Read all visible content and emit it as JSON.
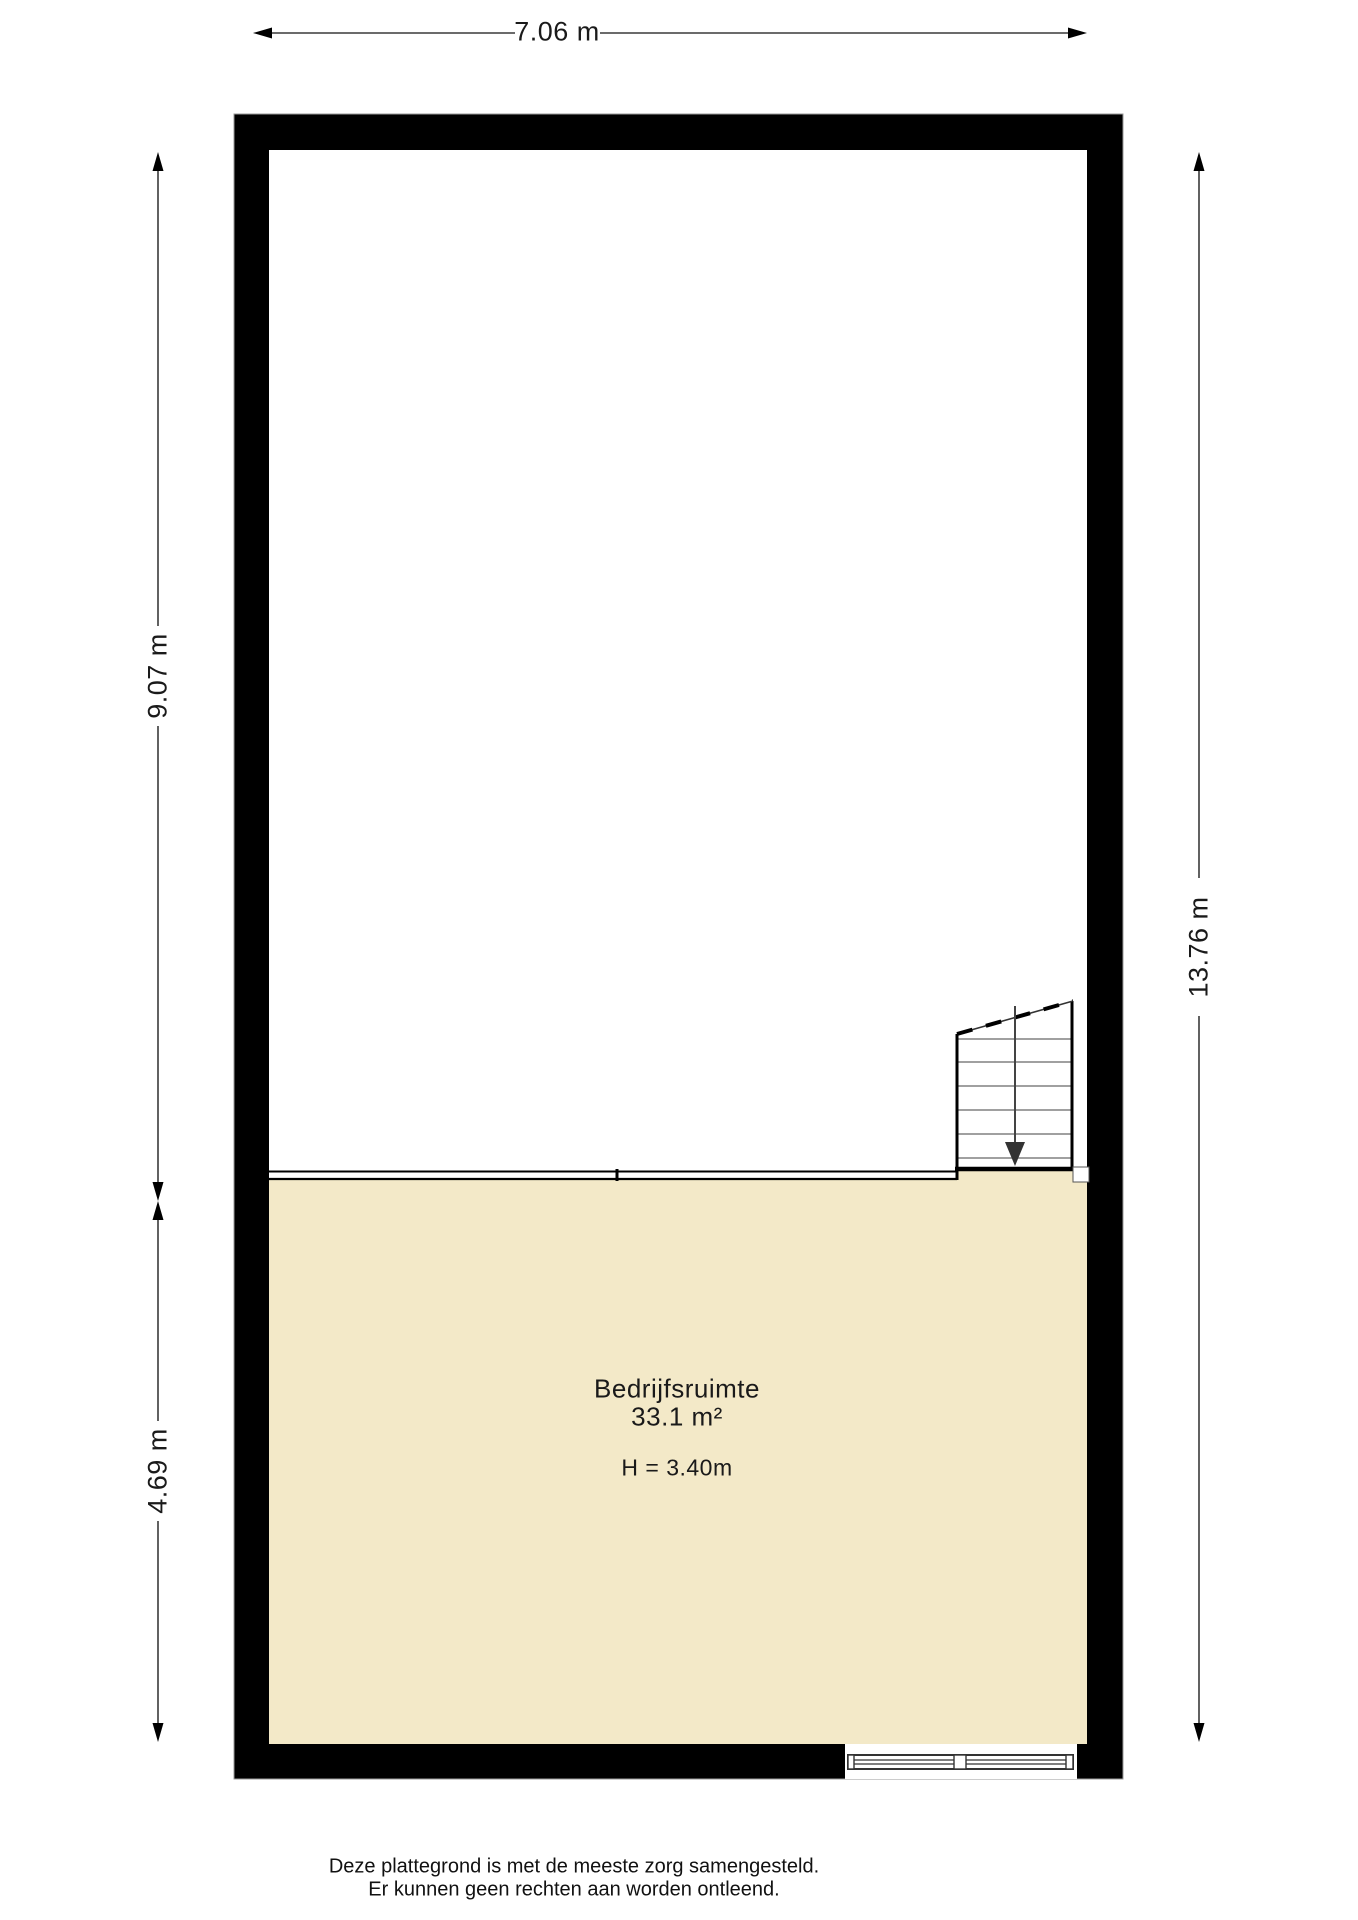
{
  "dimensions": {
    "top": "7.06 m",
    "left_upper": "9.07 m",
    "left_lower": "4.69 m",
    "right": "13.76 m"
  },
  "room": {
    "name": "Bedrijfsruimte",
    "area": "33.1 m²",
    "height": "H = 3.40m"
  },
  "footer": {
    "line1": "Deze plattegrond is met de meeste zorg samengesteld.",
    "line2": "Er kunnen geen rechten aan worden ontleend."
  },
  "colors": {
    "wall": "#000000",
    "floor": "#f3e9c8",
    "dimension_line": "#3a3a3a",
    "tread_line": "#808080"
  }
}
